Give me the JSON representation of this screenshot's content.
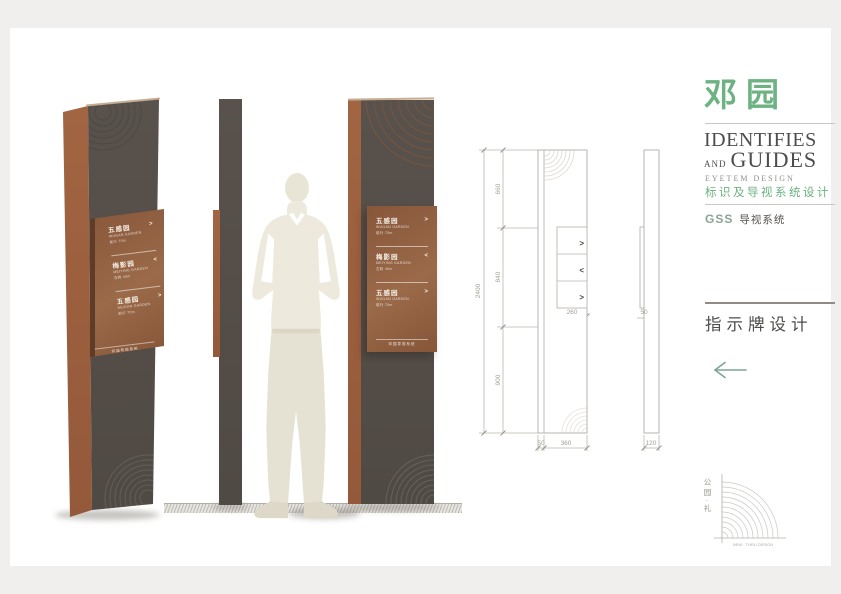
{
  "scene": {
    "entries": [
      {
        "name": "五感园",
        "arrow": ">",
        "sub1": "WUGAN GARDEN",
        "sub2": "前行 70m"
      },
      {
        "name": "梅影园",
        "arrow": "<",
        "sub1": "MEIYING GARDEN",
        "sub2": "左转 40m"
      },
      {
        "name": "五感园",
        "arrow": ">",
        "sub1": "WUGAN GARDEN",
        "sub2": "前行 70m"
      }
    ],
    "panel_footer": "邓园导视系统"
  },
  "drawing": {
    "dims": {
      "total": "2400",
      "seg_top": "660",
      "seg_mid": "840",
      "seg_bot": "900",
      "panel_w": "260",
      "edge_w": "50",
      "face_w": "360",
      "panel_d": "50",
      "side_w": "120"
    },
    "arrow_right": ">",
    "arrow_left": "<"
  },
  "sidebar": {
    "logo": "邓园",
    "identifies": "IDENTIFIES",
    "and": "AND",
    "guides": "GUIDES",
    "eyetem": "EYETEM DESIGN",
    "subtitle_cn": "标识及导视系统设计",
    "gss": "GSS",
    "gss_name": "导视系统",
    "section": "指示牌设计",
    "fan_vertical": "公园·礼",
    "fan_caption": "NEW · THRU DESIGN"
  },
  "colors": {
    "green": "#6cb282",
    "rust": "#9a5f3e",
    "pillar": "#57504a",
    "arrow_green": "#7ba693"
  }
}
